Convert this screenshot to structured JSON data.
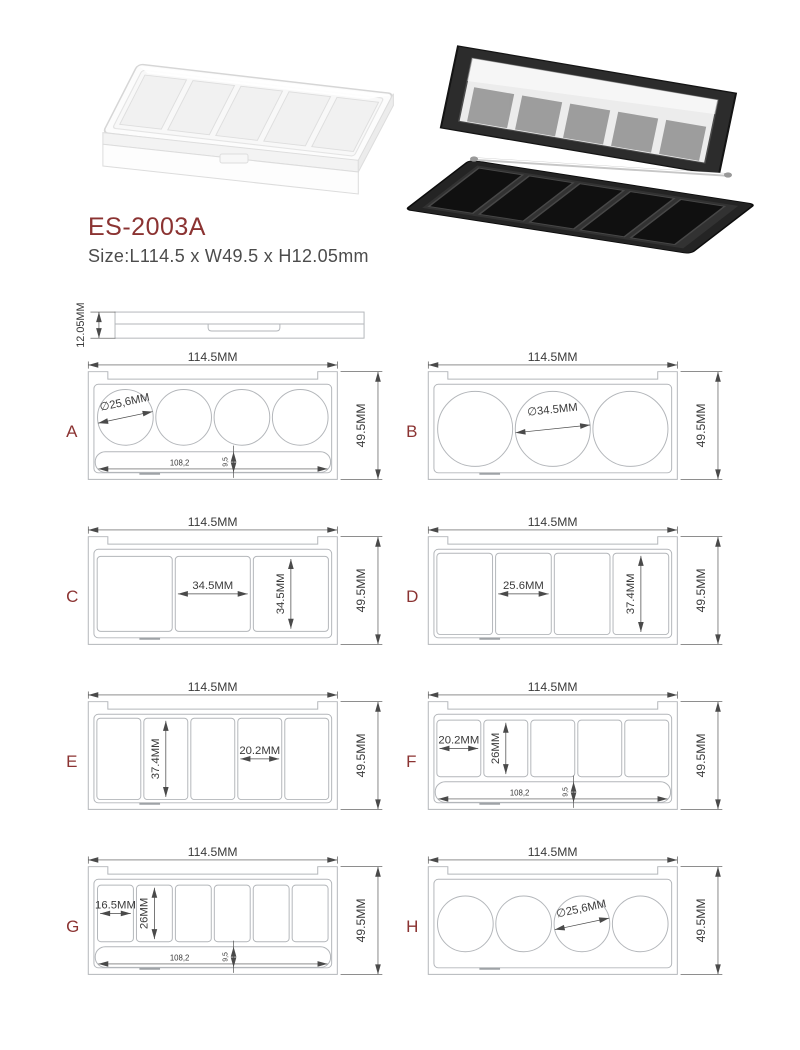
{
  "colors": {
    "accent": "#8b3332",
    "geometry_line": "#b3b6ba",
    "annotation": "#4a4a4a",
    "dim_text": "#3a3a3a"
  },
  "header": {
    "model": "ES-2003A",
    "size_line": "Size:L114.5 x W49.5 x H12.05mm"
  },
  "side_view": {
    "thickness_label": "12.05MM"
  },
  "drawings": [
    {
      "letter": "A",
      "top_dim": "114.5MM",
      "right_dim": "49.5MM",
      "wells": {
        "shape": "circle",
        "count": 4,
        "dia_mm": 25.6
      },
      "slot": {
        "present": true,
        "len_mm": 108.2,
        "h_mm": 9.5,
        "length_label": "108,2",
        "height_label": "9,5"
      },
      "annotations": [
        {
          "type": "diameter",
          "well": 0,
          "label": "∅25,6MM"
        }
      ]
    },
    {
      "letter": "B",
      "top_dim": "114.5MM",
      "right_dim": "49.5MM",
      "wells": {
        "shape": "circle",
        "count": 3,
        "dia_mm": 34.5
      },
      "slot": {
        "present": false
      },
      "annotations": [
        {
          "type": "diameter",
          "well": 1,
          "label": "∅34.5MM"
        }
      ]
    },
    {
      "letter": "C",
      "top_dim": "114.5MM",
      "right_dim": "49.5MM",
      "wells": {
        "shape": "rect",
        "count": 3,
        "w_mm": 34.5,
        "h_mm": 34.5
      },
      "slot": {
        "present": false
      },
      "annotations": [
        {
          "type": "width",
          "well": 1,
          "label": "34.5MM"
        },
        {
          "type": "height",
          "well": 2,
          "label": "34.5MM"
        }
      ]
    },
    {
      "letter": "D",
      "top_dim": "114.5MM",
      "right_dim": "49.5MM",
      "wells": {
        "shape": "rect",
        "count": 4,
        "w_mm": 25.6,
        "h_mm": 37.4
      },
      "slot": {
        "present": false
      },
      "annotations": [
        {
          "type": "width",
          "well": 1,
          "label": "25.6MM"
        },
        {
          "type": "height",
          "well": 3,
          "label": "37.4MM"
        }
      ]
    },
    {
      "letter": "E",
      "top_dim": "114.5MM",
      "right_dim": "49.5MM",
      "wells": {
        "shape": "rect",
        "count": 5,
        "w_mm": 20.2,
        "h_mm": 37.4
      },
      "slot": {
        "present": false
      },
      "annotations": [
        {
          "type": "height",
          "well": 1,
          "label": "37.4MM"
        },
        {
          "type": "width",
          "well": 3,
          "label": "20.2MM"
        }
      ]
    },
    {
      "letter": "F",
      "top_dim": "114.5MM",
      "right_dim": "49.5MM",
      "wells": {
        "shape": "rect",
        "count": 5,
        "w_mm": 20.2,
        "h_mm": 26
      },
      "slot": {
        "present": true,
        "len_mm": 108.2,
        "h_mm": 9.5,
        "length_label": "108,2",
        "height_label": "9,5"
      },
      "annotations": [
        {
          "type": "width",
          "well": 0,
          "label": "20.2MM"
        },
        {
          "type": "height",
          "well": 1,
          "label": "26MM"
        }
      ]
    },
    {
      "letter": "G",
      "top_dim": "114.5MM",
      "right_dim": "49.5MM",
      "wells": {
        "shape": "rect",
        "count": 6,
        "w_mm": 16.5,
        "h_mm": 26
      },
      "slot": {
        "present": true,
        "len_mm": 108.2,
        "h_mm": 9.5,
        "length_label": "108,2",
        "height_label": "9,5"
      },
      "annotations": [
        {
          "type": "width",
          "well": 0,
          "label": "16.5MM"
        },
        {
          "type": "height",
          "well": 1,
          "label": "26MM"
        }
      ]
    },
    {
      "letter": "H",
      "top_dim": "114.5MM",
      "right_dim": "49.5MM",
      "wells": {
        "shape": "circle",
        "count": 4,
        "dia_mm": 25.6
      },
      "slot": {
        "present": false
      },
      "annotations": [
        {
          "type": "diameter",
          "well": 2,
          "label": "∅25,6MM"
        }
      ]
    }
  ]
}
